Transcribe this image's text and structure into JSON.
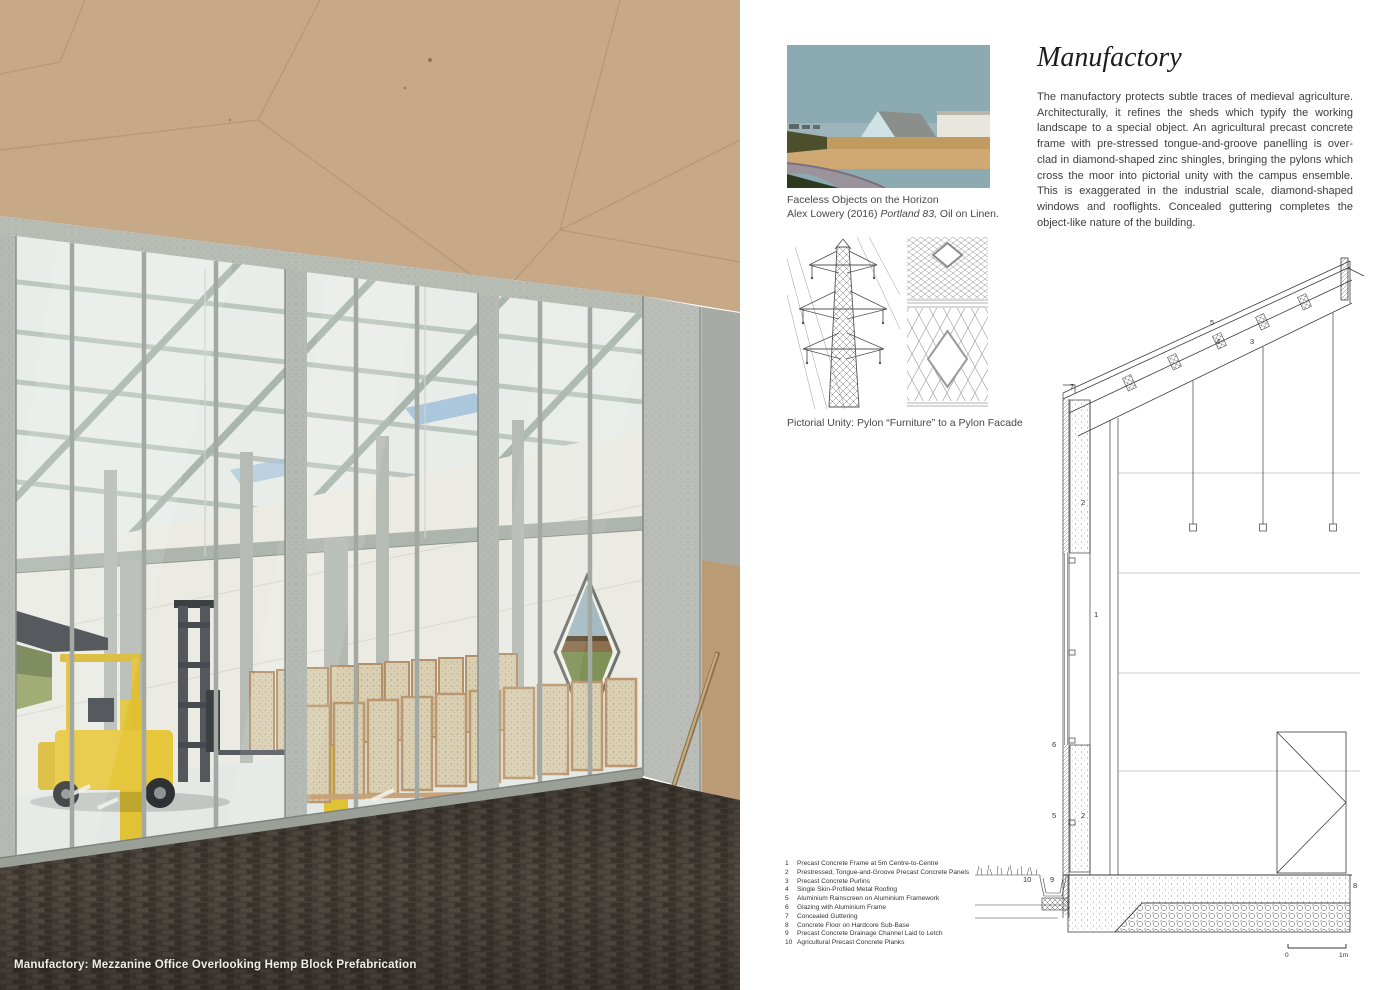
{
  "left_panel": {
    "caption": "Manufactory: Mezzanine Office Overlooking Hemp Block Prefabrication"
  },
  "right_panel": {
    "title": "Manufactory",
    "body": "The manufactory protects subtle traces of medieval agriculture. Architecturally, it refines the sheds which typify the working landscape to a special object. An agricultural precast concrete frame with pre-stressed tongue-and-groove panelling is over-clad in diamond-shaped zinc shingles, bringing the pylons which cross the moor into pictorial unity with the campus ensemble. This is exaggerated in the industrial scale, diamond-shaped windows and rooflights. Concealed guttering completes the object-like nature of the building.",
    "painting": {
      "line1": "Faceless Objects on the Horizon",
      "line2_prefix": "Alex Lowery (2016) ",
      "line2_italic": "Portland 83,",
      "line2_suffix": " Oil on Linen."
    },
    "pylon_caption": "Pictorial Unity: Pylon “Furniture” to a Pylon Facade",
    "section": {
      "callouts": [
        "5",
        "4",
        "3",
        "7",
        "2",
        "1",
        "6",
        "5",
        "2",
        "10",
        "9",
        "8"
      ],
      "scale_zero": "0",
      "scale_one": "1m",
      "legend": [
        {
          "num": "1",
          "text": "Precast Concrete Frame at 5m Centre-to-Centre"
        },
        {
          "num": "2",
          "text": "Prestressed, Tongue-and-Groove Precast Concrete Panels"
        },
        {
          "num": "3",
          "text": "Precast Concrete Purlins"
        },
        {
          "num": "4",
          "text": "Single Skin-Profiled Metal Roofing"
        },
        {
          "num": "5",
          "text": "Aluminium Rainscreen on Aluminium Framework"
        },
        {
          "num": "6",
          "text": "Glazing with Aluminium Frame"
        },
        {
          "num": "7",
          "text": "Concealed Guttering"
        },
        {
          "num": "8",
          "text": "Concrete Floor on Hardcore Sub-Base"
        },
        {
          "num": "9",
          "text": "Precast Concrete Drainage Channel Laid to Letch"
        },
        {
          "num": "10",
          "text": "Agricultural Precast Concrete Planks"
        }
      ]
    }
  },
  "colors": {
    "ceiling_tan": "#c7a987",
    "concrete_grey": "#b7bcb5",
    "safety_yellow": "#e0c335",
    "forklift_yellow": "#e6c63a",
    "rooflight_blue": "#9fc0da",
    "floor_brown": "#46403a",
    "painting_sky": "#8caab1"
  }
}
